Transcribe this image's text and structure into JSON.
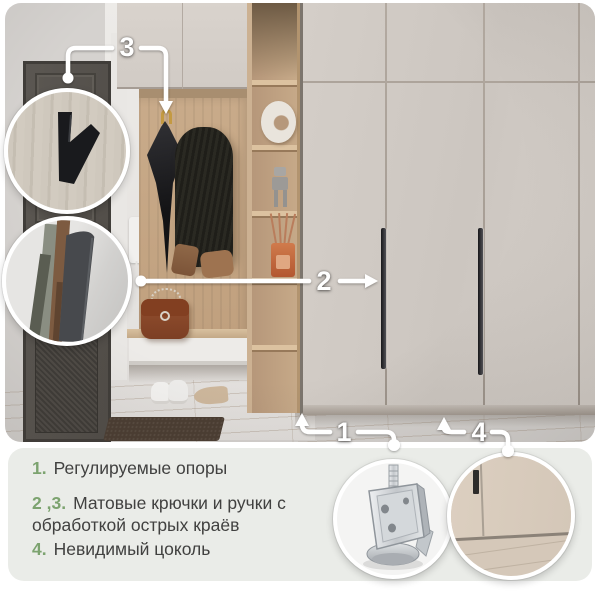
{
  "callouts": {
    "one": "1",
    "two": "2",
    "three": "3",
    "four": "4"
  },
  "legend": {
    "items": [
      {
        "num": "1.",
        "text": "Регулируемые опоры"
      },
      {
        "num": "2 ,3.",
        "text": "Матовые крючки и ручки с обработкой острых краёв"
      },
      {
        "num": "4.",
        "text": "Невидимый цоколь"
      }
    ]
  },
  "colors": {
    "accent_green": "#7ca36f",
    "legend_background": "#eaece8",
    "annotation_white": "#ffffff",
    "wardrobe_cream": "#cfc9c3",
    "wood_oak": "#c6a885"
  }
}
